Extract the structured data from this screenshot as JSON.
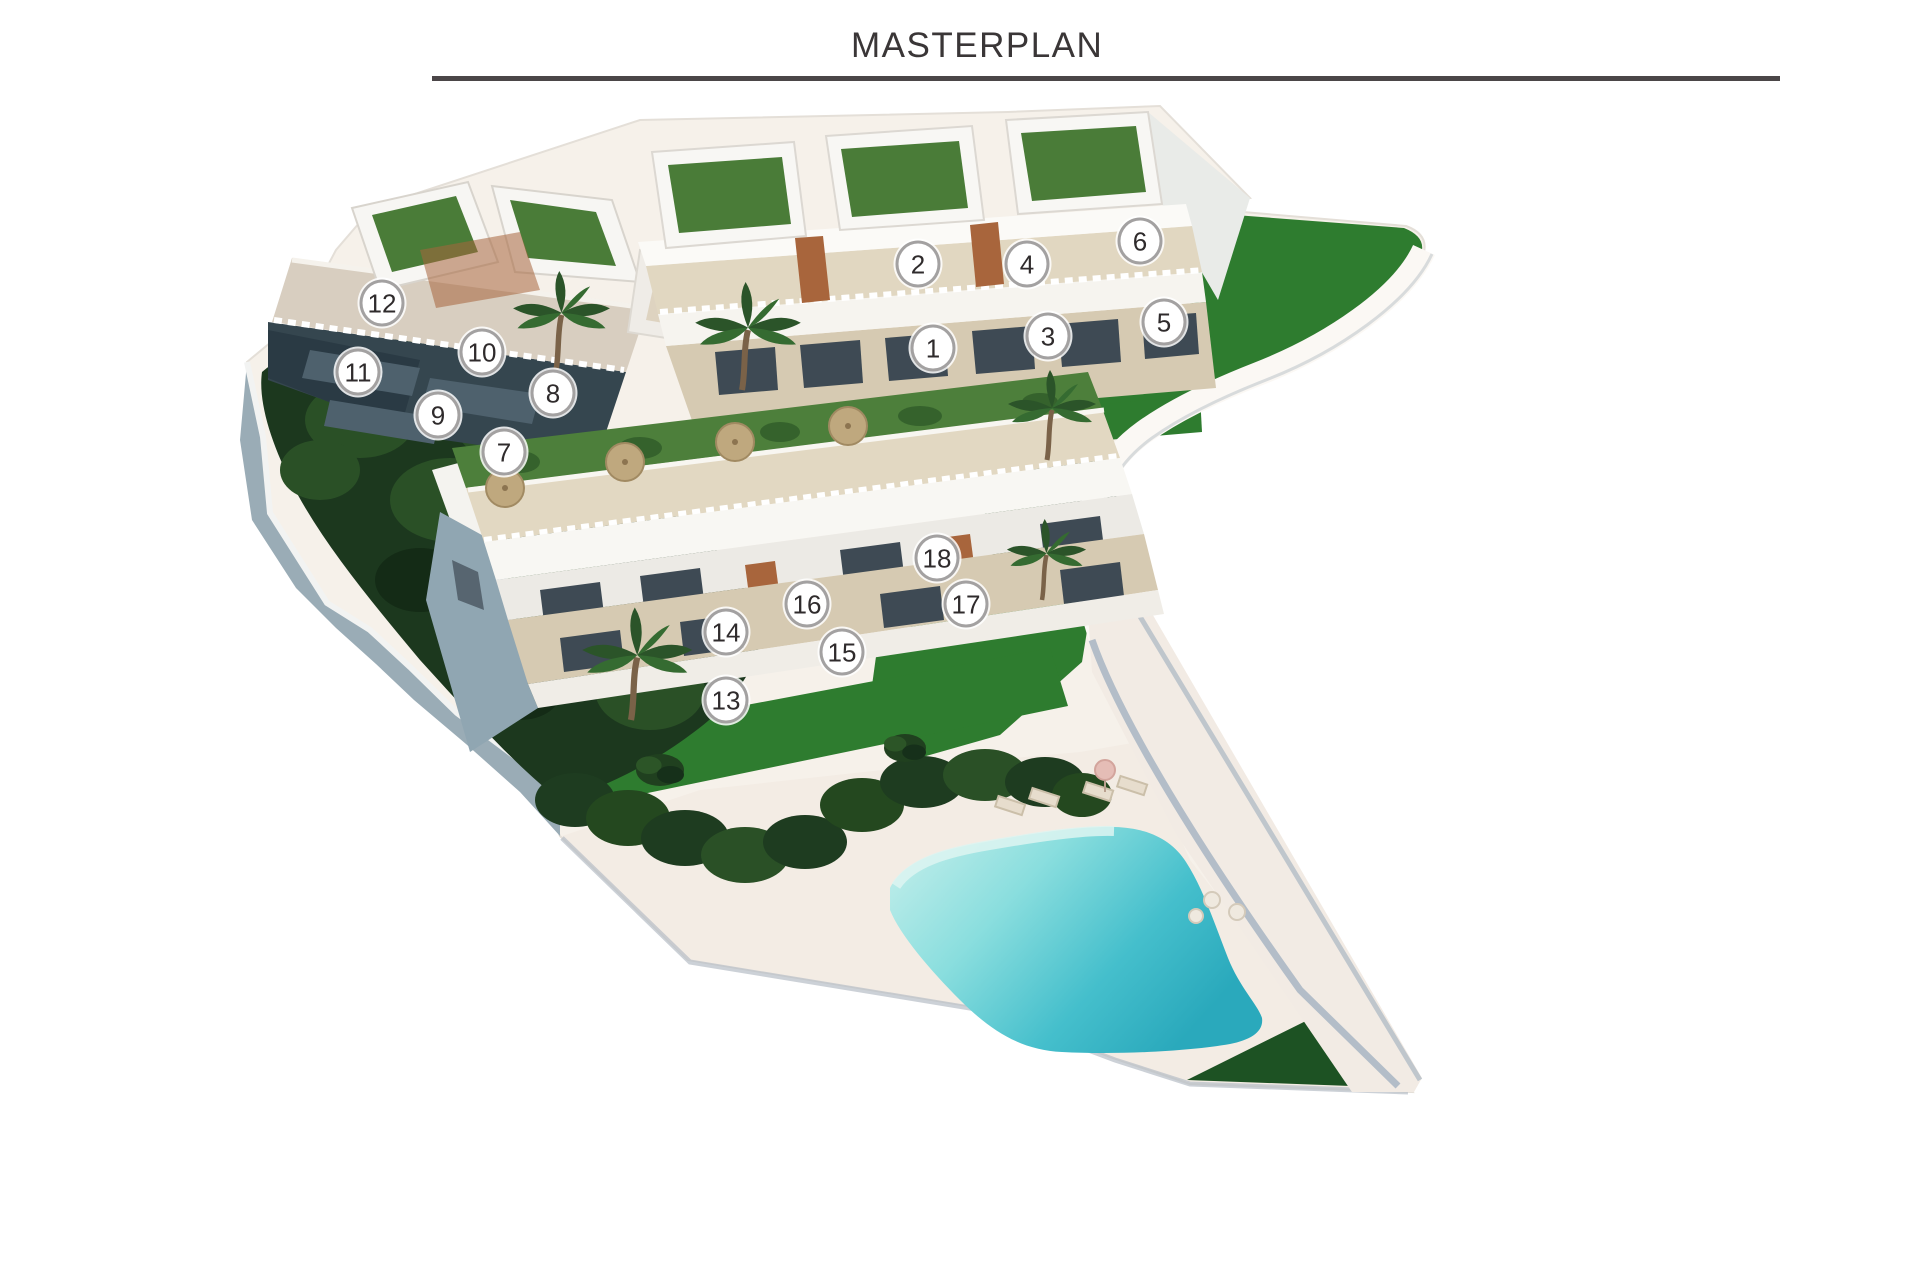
{
  "header": {
    "title": "MASTERPLAN"
  },
  "site": {
    "marker_count": 18,
    "markers": [
      {
        "number": "1",
        "x": 933,
        "y": 348
      },
      {
        "number": "2",
        "x": 918,
        "y": 264
      },
      {
        "number": "3",
        "x": 1048,
        "y": 336
      },
      {
        "number": "4",
        "x": 1027,
        "y": 264
      },
      {
        "number": "5",
        "x": 1164,
        "y": 322
      },
      {
        "number": "6",
        "x": 1140,
        "y": 241
      },
      {
        "number": "7",
        "x": 504,
        "y": 452
      },
      {
        "number": "8",
        "x": 553,
        "y": 393
      },
      {
        "number": "9",
        "x": 438,
        "y": 415
      },
      {
        "number": "10",
        "x": 482,
        "y": 352
      },
      {
        "number": "11",
        "x": 358,
        "y": 372
      },
      {
        "number": "12",
        "x": 382,
        "y": 303
      },
      {
        "number": "13",
        "x": 726,
        "y": 700
      },
      {
        "number": "14",
        "x": 726,
        "y": 632
      },
      {
        "number": "15",
        "x": 842,
        "y": 652
      },
      {
        "number": "16",
        "x": 807,
        "y": 604
      },
      {
        "number": "17",
        "x": 966,
        "y": 604
      },
      {
        "number": "18",
        "x": 937,
        "y": 558
      }
    ],
    "colors": {
      "title_text": "#3a3637",
      "rule_line": "#4b4648",
      "marker_border": "#a3a1a1",
      "marker_fill": "#ffffff",
      "marker_text": "#2f2b2c",
      "lawn_green": "#2e7c2f",
      "dark_grass_green": "#1d5223",
      "hedge_green": "#1c381e",
      "roof_garden_green": "#4d7f3b",
      "stone_beige": "#d6cab2",
      "terrace_beige": "#e1d7c1",
      "deck_cream": "#f3ece4",
      "pool_light": "#a9e7e4",
      "pool_deep": "#2fb4c4",
      "wall_shadow_blue": "#9aacb6",
      "facade_shadow": "#35464f",
      "building_white": "#f8f7f4"
    }
  }
}
